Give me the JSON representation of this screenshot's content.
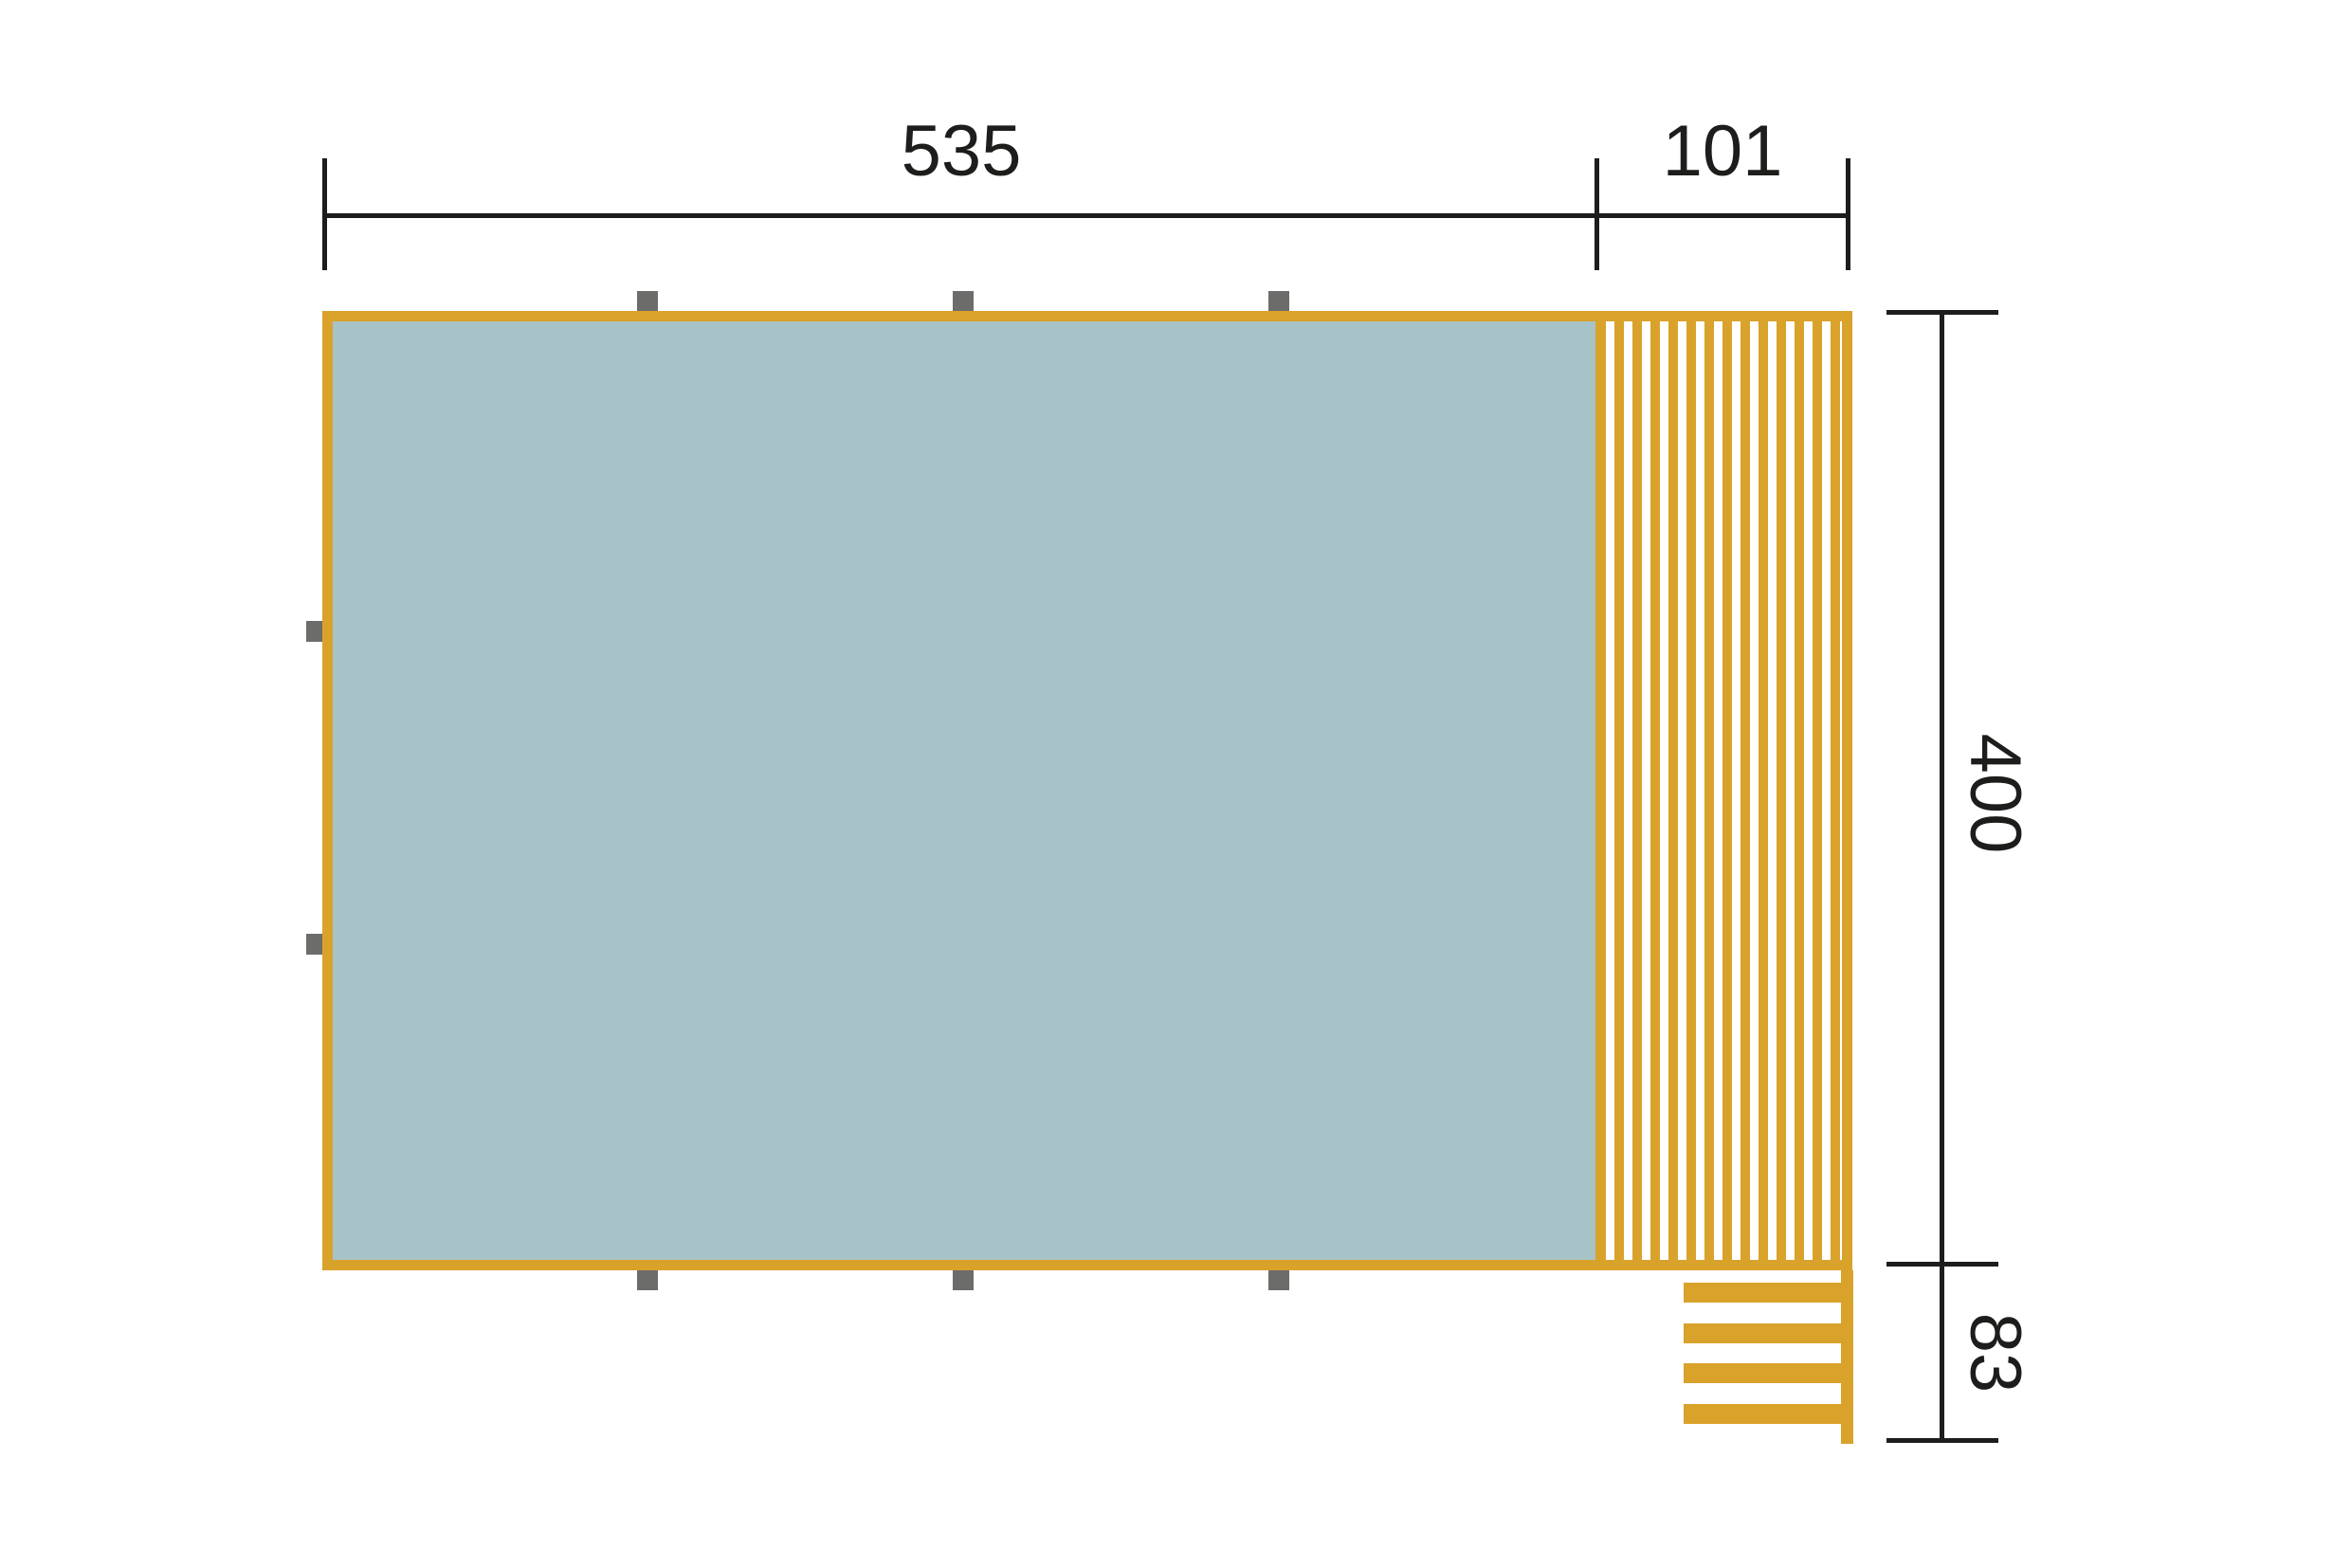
{
  "diagram": {
    "kind": "dimensioned floor plan",
    "dimensions": {
      "width_main": "535",
      "width_deck": "101",
      "height_main": "400",
      "stairs_depth": "83"
    },
    "colors": {
      "wood": "#D9A22B",
      "floor": "#A8C3C8",
      "post": "#6C6C6A",
      "line": "#1D1D1B",
      "background": "#FFFFFF"
    },
    "counts": {
      "top_posts": 3,
      "bottom_posts": 3,
      "left_posts": 2,
      "stair_steps": 4,
      "deck_slats": 13
    }
  }
}
